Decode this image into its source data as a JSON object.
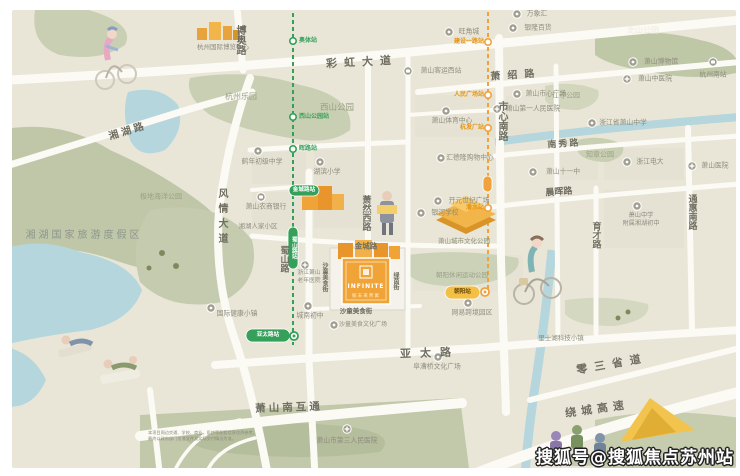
{
  "watermark": "搜狐号@搜狐焦点苏州站",
  "project": {
    "name_en": "INFINITE",
    "name_cn": "赋未来青寓"
  },
  "disclaimer": [
    "本项目周边交通、学校、商业、医疗等配套信息仅供参考，",
    "最终以政府部门批准文件及实际交付情况为准。"
  ],
  "colors": {
    "map_bg": "#e9e6d8",
    "road": "#fbfaf4",
    "park": "#c9cfb2",
    "water": "#b5d6dd",
    "metro_green": "#35a05a",
    "metro_yellow": "#f0a23c",
    "project_orange": "#f0a437"
  },
  "road_labels": [
    {
      "t": "彩虹大道",
      "x": 362,
      "y": 62,
      "s": 11,
      "ls": 7,
      "r": -3
    },
    {
      "t": "博奥路",
      "x": 239,
      "y": 40,
      "s": 10,
      "v": 1
    },
    {
      "t": "湘湖路",
      "x": 128,
      "y": 132,
      "s": 10,
      "ls": 3,
      "r": -17
    },
    {
      "t": "风情大道",
      "x": 221,
      "y": 218,
      "s": 10,
      "ls": 5,
      "v": 1
    },
    {
      "t": "蜀山路",
      "x": 283,
      "y": 259,
      "s": 9,
      "v": 1
    },
    {
      "t": "萧然西路",
      "x": 365,
      "y": 213,
      "s": 9,
      "v": 1
    },
    {
      "t": "市心南路",
      "x": 501,
      "y": 121,
      "s": 10,
      "v": 1
    },
    {
      "t": "萧绍路",
      "x": 516,
      "y": 76,
      "s": 10,
      "ls": 7,
      "r": -4
    },
    {
      "t": "南秀路",
      "x": 564,
      "y": 145,
      "s": 9,
      "ls": 2,
      "r": -4
    },
    {
      "t": "晨晖路",
      "x": 559,
      "y": 193,
      "s": 9,
      "r": -4
    },
    {
      "t": "育才路",
      "x": 595,
      "y": 235,
      "s": 9,
      "v": 1
    },
    {
      "t": "通惠南路",
      "x": 691,
      "y": 212,
      "s": 9,
      "v": 1
    },
    {
      "t": "金城路",
      "x": 366,
      "y": 246,
      "s": 7.5
    },
    {
      "t": "亚太路",
      "x": 430,
      "y": 353,
      "s": 11,
      "ls": 9,
      "r": -2
    },
    {
      "t": "零三省道",
      "x": 612,
      "y": 364,
      "s": 11,
      "ls": 7,
      "r": -10
    },
    {
      "t": "绕城高速",
      "x": 597,
      "y": 409,
      "s": 11,
      "ls": 5,
      "r": -8
    },
    {
      "t": "萧山南互通",
      "x": 289,
      "y": 408,
      "s": 10.5,
      "ls": 3,
      "r": -2
    },
    {
      "t": "沙童美食街",
      "x": 356,
      "y": 311,
      "s": 6.5
    },
    {
      "t": "绿茵街",
      "x": 395,
      "y": 281,
      "s": 6,
      "v": 1
    },
    {
      "t": "沙童美食街",
      "x": 324,
      "y": 277,
      "s": 6,
      "v": 1
    }
  ],
  "area_labels": [
    {
      "t": "西山公园",
      "x": 337,
      "y": 108,
      "s": 8.5,
      "c": "#9aa085"
    },
    {
      "t": "北山公园",
      "x": 643,
      "y": 31,
      "s": 8,
      "c": "#edebdc"
    },
    {
      "t": "杭州乐园",
      "x": 241,
      "y": 97,
      "s": 8,
      "c": "#9aa085"
    },
    {
      "t": "极地海洋公园",
      "x": 161,
      "y": 197,
      "s": 7,
      "c": "#9aa085"
    },
    {
      "t": "湘湖国家旅游度假区",
      "x": 84,
      "y": 236,
      "s": 10,
      "ls": 3,
      "c": "#8d968d"
    },
    {
      "t": "知章公园",
      "x": 600,
      "y": 155,
      "s": 7,
      "c": "#9aa085"
    },
    {
      "t": "江寺公园",
      "x": 566,
      "y": 96,
      "s": 7,
      "c": "#9aa085"
    },
    {
      "t": "萧山城市文化公园",
      "x": 464,
      "y": 241,
      "s": 6.5,
      "c": "#8e9278"
    },
    {
      "t": "朝阳休闲运动公园",
      "x": 462,
      "y": 275,
      "s": 6.5,
      "c": "#9aa085"
    },
    {
      "t": "里士湖科技小镇",
      "x": 561,
      "y": 338,
      "s": 6.5,
      "c": "#8f8d7e"
    },
    {
      "t": "湘湖人家小区",
      "x": 258,
      "y": 226,
      "s": 6.5,
      "c": "#8f8d7e"
    }
  ],
  "pois": [
    {
      "t": "杭州国际博览中心",
      "ix": -1,
      "iy": -1,
      "lx": 223,
      "ly": 47,
      "s": 6.5,
      "type": "none"
    },
    {
      "t": "旺角城",
      "ix": 449,
      "iy": 32,
      "lx": 469,
      "ly": 32,
      "type": "dot"
    },
    {
      "t": "万象汇",
      "ix": 517,
      "iy": 14,
      "lx": 537,
      "ly": 14,
      "type": "dot"
    },
    {
      "t": "银隆百货",
      "ix": 513,
      "iy": 28,
      "lx": 538,
      "ly": 28,
      "type": "dot"
    },
    {
      "t": "萧山客运西站",
      "ix": 408,
      "iy": 71,
      "lx": 441,
      "ly": 71,
      "type": "bus"
    },
    {
      "t": "萧山市心广场",
      "ix": 517,
      "iy": 94,
      "lx": 546,
      "ly": 94,
      "type": "dot"
    },
    {
      "t": "萧山第一人民医院",
      "ix": 497,
      "iy": 109,
      "lx": 533,
      "ly": 109,
      "type": "cross"
    },
    {
      "t": "萧山博物馆",
      "ix": 633,
      "iy": 62,
      "lx": 661,
      "ly": 62,
      "type": "dot"
    },
    {
      "t": "萧山中医院",
      "ix": 627,
      "iy": 79,
      "lx": 655,
      "ly": 79,
      "type": "cross"
    },
    {
      "t": "杭州南站",
      "ix": 713,
      "iy": 62,
      "lx": 713,
      "ly": 75,
      "type": "train"
    },
    {
      "t": "浙江省萧山中学",
      "ix": 592,
      "iy": 123,
      "lx": 623,
      "ly": 123,
      "type": "dot"
    },
    {
      "t": "浙江电大",
      "ix": 627,
      "iy": 162,
      "lx": 650,
      "ly": 162,
      "type": "dot"
    },
    {
      "t": "萧山医院",
      "ix": 692,
      "iy": 166,
      "lx": 715,
      "ly": 166,
      "type": "cross"
    },
    {
      "t": "萧山十一中",
      "ix": 533,
      "iy": 172,
      "lx": 563,
      "ly": 172,
      "type": "dot"
    },
    {
      "t": "萧山中学",
      "t2": "附属湘湖初中",
      "ix": 637,
      "iy": 206,
      "lx": 641,
      "ly": 216,
      "s": 6.2,
      "type": "dot"
    },
    {
      "t": "汇德隆购物中心",
      "ix": 441,
      "iy": 158,
      "lx": 470,
      "ly": 158,
      "type": "dot"
    },
    {
      "t": "开元世纪广场",
      "ix": 438,
      "iy": 201,
      "lx": 469,
      "ly": 201,
      "type": "dot"
    },
    {
      "t": "银河学校",
      "ix": 421,
      "iy": 213,
      "lx": 445,
      "ly": 213,
      "type": "dot"
    },
    {
      "t": "鹤年初级中学",
      "ix": 258,
      "iy": 151,
      "lx": 262,
      "ly": 162,
      "type": "dot"
    },
    {
      "t": "湖滨小学",
      "ix": 320,
      "iy": 162,
      "lx": 327,
      "ly": 172,
      "type": "dot"
    },
    {
      "t": "萧山农商银行",
      "ix": 261,
      "iy": 197,
      "lx": 266,
      "ly": 207,
      "type": "bank"
    },
    {
      "t": "浙江萧山",
      "t2": "老年医院",
      "ix": 305,
      "iy": 265,
      "lx": 309,
      "ly": 274,
      "s": 5.8,
      "type": "cross"
    },
    {
      "t": "城南初中",
      "ix": 308,
      "iy": 306,
      "lx": 310,
      "ly": 316,
      "type": "dot"
    },
    {
      "t": "沙童美食文化广场",
      "ix": 334,
      "iy": 325,
      "lx": 363,
      "ly": 325,
      "s": 6,
      "type": "dot"
    },
    {
      "t": "网易跨境园区",
      "ix": 468,
      "iy": 303,
      "lx": 472,
      "ly": 313,
      "type": "dot"
    },
    {
      "t": "阜漕桥文化广场",
      "ix": 438,
      "iy": 357,
      "lx": 437,
      "ly": 367,
      "type": "dot"
    },
    {
      "t": "国际健康小镇",
      "ix": 211,
      "iy": 308,
      "lx": 237,
      "ly": 314,
      "type": "dot"
    },
    {
      "t": "萧山市第三人民医院",
      "ix": 347,
      "iy": 429,
      "lx": 347,
      "ly": 441,
      "type": "cross"
    },
    {
      "t": "萧山体育中心",
      "ix": 446,
      "iy": 111,
      "lx": 452,
      "ly": 121,
      "type": "dot"
    }
  ],
  "metro": {
    "green": {
      "color": "#35a05a",
      "stations": [
        {
          "t": "奥体站",
          "kind": "circle",
          "x": 293,
          "y": 41,
          "lx": 299,
          "ly": 41,
          "a": "start"
        },
        {
          "t": "西山公园站",
          "kind": "circle",
          "x": 293,
          "y": 117,
          "lx": 299,
          "ly": 117,
          "a": "start"
        },
        {
          "t": "晖路站",
          "kind": "circle",
          "x": 293,
          "y": 149,
          "lx": 299,
          "ly": 149,
          "a": "start"
        },
        {
          "t": "金城路站",
          "kind": "pill",
          "x": 289,
          "y": 185,
          "w": 30,
          "h": 11
        },
        {
          "t": "蜀山路站",
          "kind": "pillv",
          "x": 288,
          "y": 227,
          "w": 10,
          "h": 42
        },
        {
          "t": "亚太路站",
          "kind": "badge",
          "x": 246,
          "y": 329,
          "w": 44,
          "h": 13,
          "cx": 294,
          "cy": 336
        }
      ]
    },
    "yellow": {
      "color": "#f0a23c",
      "stations": [
        {
          "t": "建设一路站",
          "kind": "circle",
          "x": 488,
          "y": 42,
          "lx": 484,
          "ly": 42,
          "a": "end"
        },
        {
          "t": "人民广场站",
          "kind": "circle",
          "x": 488,
          "y": 95,
          "lx": 484,
          "ly": 95,
          "a": "end"
        },
        {
          "t": "杭发厂站",
          "kind": "circle",
          "x": 488,
          "y": 128,
          "lx": 484,
          "ly": 128,
          "a": "end"
        },
        {
          "t": "",
          "kind": "pill",
          "x": 483,
          "y": 176,
          "w": 9,
          "h": 16
        },
        {
          "t": "潘水站",
          "kind": "circle",
          "x": 488,
          "y": 208,
          "lx": 484,
          "ly": 208,
          "a": "end"
        },
        {
          "t": "朝阳站",
          "kind": "badge",
          "x": 445,
          "y": 286,
          "w": 35,
          "h": 13,
          "cx": 485,
          "cy": 292
        }
      ]
    }
  }
}
